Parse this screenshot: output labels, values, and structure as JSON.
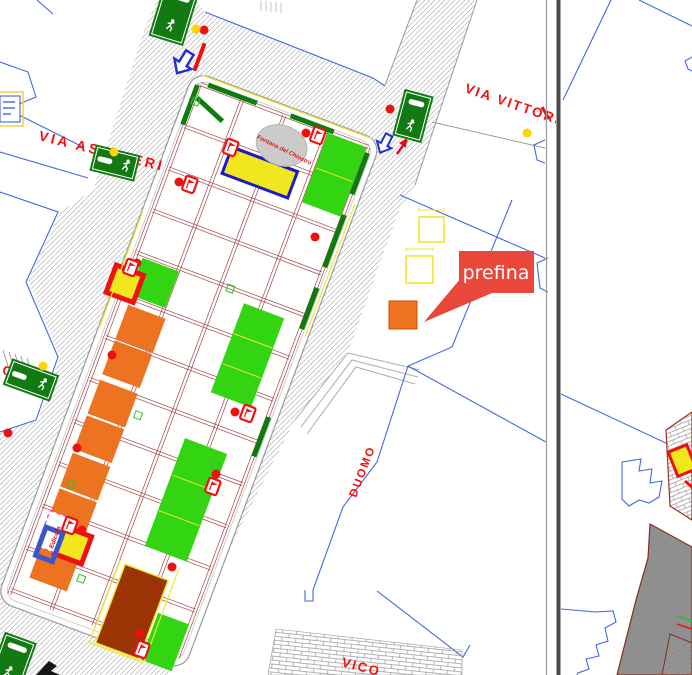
{
  "labels": {
    "street_left": "VIA ASCHIERI",
    "street_top_right": "VIA VITTORIO VE",
    "duomo": "DUOMO",
    "fountain": "Fontana del Chiostro",
    "kiosk": "Edicola",
    "street_bottom_partial": "VICO",
    "street_left_partial": "LO",
    "tooltip": "prefina"
  },
  "colors": {
    "hatch_line": "#c2c2c2",
    "street_text": "#f50f0f",
    "building_outline": "#4169e1",
    "market_grid": "#a34848",
    "stall_green": "#33d411",
    "stall_orange": "#ed7320",
    "stall_yellow": "#f2e71e",
    "stall_brown": "#9b3305",
    "sign_green": "#137a13",
    "marker_red": "#ee1111",
    "marker_yellow": "#ffd400",
    "dash_green": "#0c7c0c",
    "dim_yellow": "#f0e830",
    "tooltip_red": "#e8473a",
    "pink_dash": "#ee44ee",
    "blue_shape": "#3a56c8",
    "gray_fill": "#8f8f8f"
  },
  "market": {
    "origin": [
      200,
      84
    ],
    "rotation": 20.5,
    "size": [
      180,
      545
    ],
    "stalls": [
      {
        "x": 137,
        "y": 1,
        "w": 41,
        "h": 74,
        "f": "stall_green",
        "divs": [
          38
        ]
      },
      {
        "x": 7,
        "y": 183,
        "w": 39,
        "h": 39,
        "f": "stall_green"
      },
      {
        "x": 118,
        "y": 190,
        "w": 43,
        "h": 95,
        "f": "stall_green",
        "divs": [
          222,
          254
        ]
      },
      {
        "x": 110,
        "y": 337,
        "w": 45,
        "h": 115,
        "f": "stall_green",
        "divs": [
          376,
          414
        ]
      },
      {
        "x": 146,
        "y": 510,
        "w": 33,
        "h": 50,
        "f": "stall_green"
      },
      {
        "x": 10,
        "y": 232,
        "w": 40,
        "h": 36,
        "f": "stall_orange"
      },
      {
        "x": 10,
        "y": 270,
        "w": 40,
        "h": 36,
        "f": "stall_orange"
      },
      {
        "x": 10,
        "y": 312,
        "w": 40,
        "h": 36,
        "f": "stall_orange"
      },
      {
        "x": 10,
        "y": 350,
        "w": 40,
        "h": 36,
        "f": "stall_orange"
      },
      {
        "x": 10,
        "y": 390,
        "w": 40,
        "h": 36,
        "f": "stall_orange"
      },
      {
        "x": 10,
        "y": 428,
        "w": 40,
        "h": 36,
        "f": "stall_orange"
      },
      {
        "x": 13,
        "y": 488,
        "w": 40,
        "h": 34,
        "f": "stall_orange"
      },
      {
        "x": 52,
        "y": 48,
        "w": 70,
        "h": 28,
        "f": "stall_yellow",
        "s": "#1a1acc",
        "sw": 3
      },
      {
        "x": -15,
        "y": 199,
        "w": 29,
        "h": 29,
        "f": "stall_yellow",
        "s": "marker_red",
        "sw": 5
      },
      {
        "x": 28,
        "y": 462,
        "w": 29,
        "h": 29,
        "f": "stall_yellow",
        "s": "marker_red",
        "sw": 5
      },
      {
        "x": 98,
        "y": 476,
        "w": 46,
        "h": 84,
        "f": "stall_brown",
        "s": "dim_yellow",
        "sw": 1.5
      },
      {
        "x": 9,
        "y": 452,
        "w": 22,
        "h": 38,
        "f": "#ffffff",
        "s": "pink_dash",
        "sw": 1.4,
        "dash": 1
      },
      {
        "x": 11,
        "y": 469,
        "w": 18,
        "h": 30,
        "f": "none",
        "s": "blue_shape",
        "sw": 5
      }
    ],
    "green_dashes": [
      [
        8,
        -2,
        60,
        -2
      ],
      [
        96,
        -2,
        142,
        -2
      ],
      [
        2,
        14,
        34,
        27
      ],
      [
        -2,
        2,
        -2,
        44
      ],
      [
        181,
        6,
        181,
        50
      ],
      [
        181,
        72,
        181,
        128
      ],
      [
        181,
        150,
        181,
        194
      ],
      [
        181,
        288,
        181,
        330
      ]
    ],
    "green_squares": [
      [
        2,
        18
      ],
      [
        100,
        181
      ],
      [
        58,
        332
      ],
      [
        20,
        420
      ],
      [
        148,
        352
      ],
      [
        62,
        505
      ]
    ],
    "dim_lines": [
      [
        -2,
        -9,
        180,
        -9
      ],
      [
        187,
        58,
        187,
        200
      ],
      [
        -9,
        140,
        -9,
        262
      ],
      [
        92,
        474,
        92,
        562
      ],
      [
        150,
        460,
        150,
        562
      ],
      [
        92,
        562,
        150,
        562
      ]
    ],
    "fountain_ellipse": {
      "cx": 98,
      "cy": 29,
      "rx": 26,
      "ry": 20
    }
  },
  "signs": [
    {
      "cx": 174,
      "cy": 14,
      "w": 36,
      "h": 56,
      "rot": 17,
      "t": "v"
    },
    {
      "cx": 413,
      "cy": 116,
      "w": 30,
      "h": 48,
      "rot": 15,
      "t": "v"
    },
    {
      "cx": 115,
      "cy": 163,
      "w": 46,
      "h": 27,
      "rot": 14,
      "t": "h"
    },
    {
      "cx": 31,
      "cy": 380,
      "w": 50,
      "h": 28,
      "rot": 20,
      "t": "h"
    },
    {
      "cx": 12,
      "cy": 662,
      "w": 34,
      "h": 52,
      "rot": 20,
      "t": "v"
    }
  ],
  "markers": {
    "red_dots": [
      [
        204,
        30
      ],
      [
        179,
        182
      ],
      [
        306,
        133
      ],
      [
        137,
        263
      ],
      [
        112,
        355
      ],
      [
        8,
        433
      ],
      [
        77,
        448
      ],
      [
        235,
        412
      ],
      [
        216,
        474
      ],
      [
        172,
        567
      ],
      [
        82,
        530
      ],
      [
        140,
        634
      ],
      [
        315,
        237
      ],
      [
        390,
        109
      ]
    ],
    "yellow_dots": [
      [
        196,
        29
      ],
      [
        114,
        152
      ],
      [
        527,
        133
      ],
      [
        43,
        366
      ],
      [
        675,
        605
      ]
    ],
    "flags": [
      [
        190,
        184
      ],
      [
        231,
        147
      ],
      [
        318,
        135
      ],
      [
        131,
        267
      ],
      [
        248,
        413
      ],
      [
        213,
        486
      ],
      [
        70,
        525
      ],
      [
        142,
        649
      ]
    ]
  },
  "yellow_squares": [
    {
      "x": 419,
      "y": 217,
      "s": 25
    },
    {
      "x": 406,
      "y": 256,
      "s": 27
    }
  ],
  "target_square": {
    "x": 389,
    "y": 301,
    "s": 28
  }
}
